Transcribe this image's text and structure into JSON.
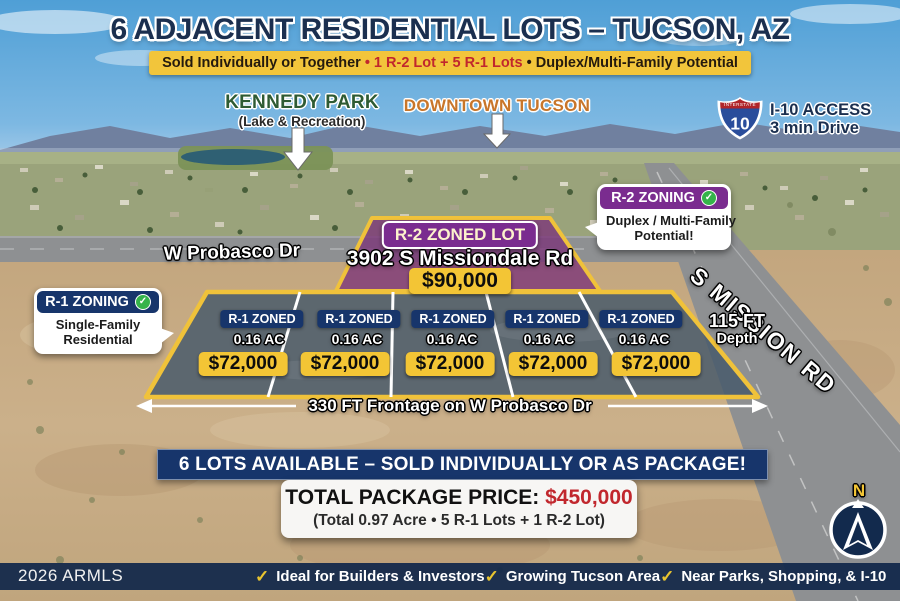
{
  "header": {
    "title": "6 ADJACENT RESIDENTIAL LOTS – TUCSON, AZ",
    "subtitle": {
      "part1": "Sold Individually or Together",
      "bullet1": "•",
      "part2": "1 R-2 Lot + 5 R-1 Lots",
      "bullet2": "•",
      "part3": "Duplex/Multi-Family Potential"
    }
  },
  "map_labels": {
    "kennedy_park": {
      "title": "KENNEDY PARK",
      "subtitle": "(Lake & Recreation)"
    },
    "downtown": "DOWNTOWN TUCSON",
    "i10": {
      "shield_top": "INTERSTATE",
      "shield_number": "10",
      "line1": "I-10 ACCESS",
      "line2": "3 min Drive"
    },
    "probasco_road": "W Probasco Dr",
    "mission_road": "S MISSION RD",
    "depth": {
      "line1": "115 FT",
      "line2": "Depth"
    },
    "frontage": "330 FT Frontage on W Probasco Dr",
    "compass_north": "N"
  },
  "zoning_callouts": {
    "r2": {
      "header": "R-2 ZONING",
      "check": "✓",
      "body_line1": "Duplex / Multi-Family",
      "body_line2": "Potential!"
    },
    "r1": {
      "header": "R-1 ZONING",
      "check": "✓",
      "body_line1": "Single-Family",
      "body_line2": "Residential"
    }
  },
  "r2_lot": {
    "badge": "R-2 ZONED LOT",
    "address": "3902 S Missiondale Rd",
    "price": "$90,000"
  },
  "r1_lots": {
    "items": [
      {
        "zone": "R-1 ZONED",
        "area": "0.16 AC",
        "price": "$72,000"
      },
      {
        "zone": "R-1 ZONED",
        "area": "0.16 AC",
        "price": "$72,000"
      },
      {
        "zone": "R-1 ZONED",
        "area": "0.16 AC",
        "price": "$72,000"
      },
      {
        "zone": "R-1 ZONED",
        "area": "0.16 AC",
        "price": "$72,000"
      },
      {
        "zone": "R-1 ZONED",
        "area": "0.16 AC",
        "price": "$72,000"
      }
    ]
  },
  "availability_banner": "6 LOTS AVAILABLE – SOLD INDIVIDUALLY OR AS PACKAGE!",
  "package": {
    "label": "TOTAL PACKAGE PRICE:",
    "price": "$450,000",
    "details": "(Total 0.97 Acre • 5 R-1 Lots + 1 R-2 Lot)"
  },
  "footer": {
    "watermark": "2026 ARMLS",
    "check": "✓",
    "items": [
      "Ideal for Builders & Investors",
      "Growing Tucson Area",
      "Near Parks, Shopping, & I-10"
    ]
  },
  "colors": {
    "title_navy": "#1b2f4f",
    "banner_yellow": "#f2c53b",
    "accent_red": "#c1272d",
    "r2_purple": "#7a2c8f",
    "r1_navy": "#17356b",
    "lot_border_yellow": "#f0c23a",
    "price_yellow": "#f3c535",
    "check_green": "#35b34a",
    "downtown_orange": "#c8762a",
    "kennedy_green": "#2e5b33"
  }
}
